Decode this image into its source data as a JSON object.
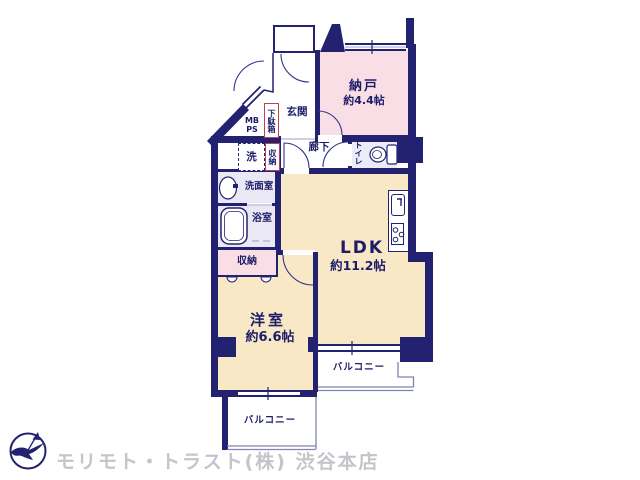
{
  "colors": {
    "wall": "#232270",
    "ink": "#1d1c68",
    "tan": "#f8e8c6",
    "pink": "#f9dee6",
    "bath": "#e9e8f4",
    "toilet": "#eaecf7",
    "red": "#c2404e",
    "thin": "#7f84b0",
    "gray": "#c4c4ca"
  },
  "rooms": {
    "nando": {
      "name": "納戸",
      "size": "約4.4帖"
    },
    "genkan": {
      "name": "玄関"
    },
    "rouka": {
      "name": "廊下"
    },
    "toilet": {
      "name": "トイレ"
    },
    "ldk": {
      "name": "LDK",
      "size": "約11.2帖"
    },
    "western_room": {
      "name": "洋室",
      "size": "約6.6帖"
    },
    "washroom": {
      "name": "洗面室"
    },
    "bathroom": {
      "name": "浴室"
    },
    "closet": {
      "name": "収納"
    },
    "entry_closet": {
      "name": "収納"
    },
    "shoe_cabinet": {
      "name": "下駄箱"
    },
    "meter_pipe_space": {
      "line1": "MB",
      "line2": "PS"
    },
    "washer": {
      "name": "洗"
    },
    "balcony_right": {
      "name": "バルコニー"
    },
    "balcony_bottom": {
      "name": "バルコニー"
    }
  },
  "footer": {
    "company": "モリモト・トラスト(株) 渋谷本店"
  }
}
